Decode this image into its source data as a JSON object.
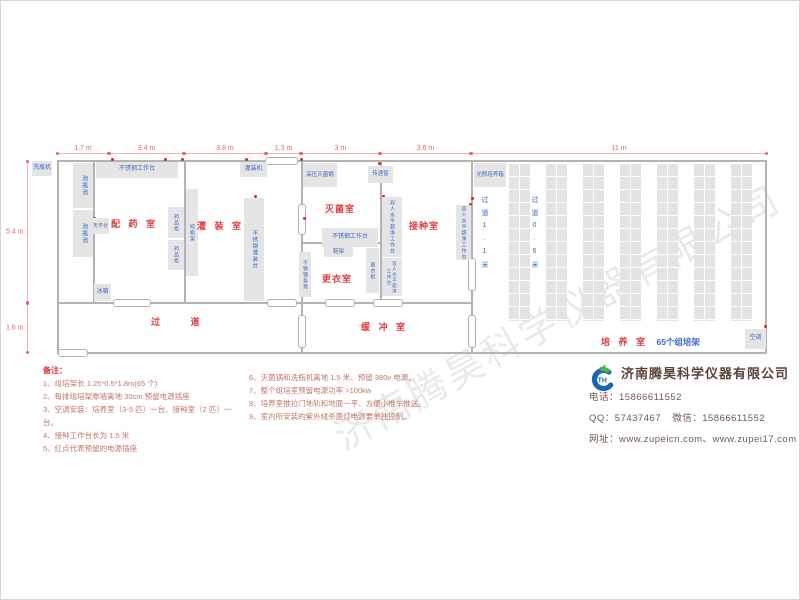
{
  "watermark": "济南腾昊科学仪器有限公司",
  "dimensions": {
    "top": [
      "1.7 m",
      "3.4 m",
      "3.8 m",
      "1.3 m",
      "3 m",
      "3.6 m",
      "11 m"
    ],
    "left_upper": "5.4 m",
    "left_lower": "1.6 m"
  },
  "rooms": {
    "dispensing": "配 药 室",
    "filling": "灌 装 室",
    "sterilization": "灭菌室",
    "inoculation": "接种室",
    "changing": "更衣室",
    "buffer": "缓 冲 室",
    "corridor": "过 道",
    "cultivation": "培 养 室",
    "cultivation_racks": "65个组培架"
  },
  "equipment": {
    "bottle_washer": "洗瓶机",
    "soaking_pool": "泡瓶池",
    "steel_worktable": "不锈钢工作台",
    "balance_table": "天平台",
    "medicine_cabinet": "药品柜",
    "fridge": "冰箱",
    "bottle_rack": "晾瓶架",
    "filling_machine": "灌装机",
    "steel_filling_table": "不锈钢灌装台",
    "autoclave": "高压灭菌锅",
    "pass_window": "传递窗",
    "shoe_rack": "鞋架",
    "steel_bench": "不锈钢条凳",
    "wardrobe": "更衣柜",
    "clean_bench": "双人水平超净工作台",
    "light_incubator": "光照培养箱",
    "air_conditioner": "空调",
    "aisle_wide": "过道1.1米",
    "aisle_narrow": "过道0.6米"
  },
  "notes": {
    "title": "备注：",
    "col1": [
      "1、组培架长 1.25*0.5*1.8m(65 个)",
      "2、每排组培架靠墙离地 30cm 预留电源插座",
      "3、空调安装：培养室（3-5 匹）一台、接种室（2 匹）一台。",
      "4、接种工作台长为 1.5 米",
      "5、红点代表预留的电源插座"
    ],
    "col2": [
      "6、灭菌锅和洗瓶机离地 1.5 米、预留 380v 电源。",
      "7、整个组培室预留电源功率 >100kw",
      "8、培养室推拉门地轨和地面一平、方便小推车推送。",
      "9、室内所安装的紫外线杀菌灯电源要单独控制。"
    ]
  },
  "company": {
    "name": "济南腾昊科学仪器有限公司",
    "logo_monogram": "TH",
    "phone_label": "电话：",
    "phone": "15866611552",
    "qq_label": "QQ：",
    "qq": "57437467",
    "wechat_label": "微信：",
    "wechat": "15866611552",
    "web_label": "网址：",
    "websites": "www.zupeicn.com、www.zupei17.com"
  },
  "colors": {
    "room_label": "#e03a3a",
    "equipment_label": "#3a6bc4",
    "dimension_text": "#e06868",
    "notes_text": "#c1766b",
    "company_name": "#5c4137"
  }
}
